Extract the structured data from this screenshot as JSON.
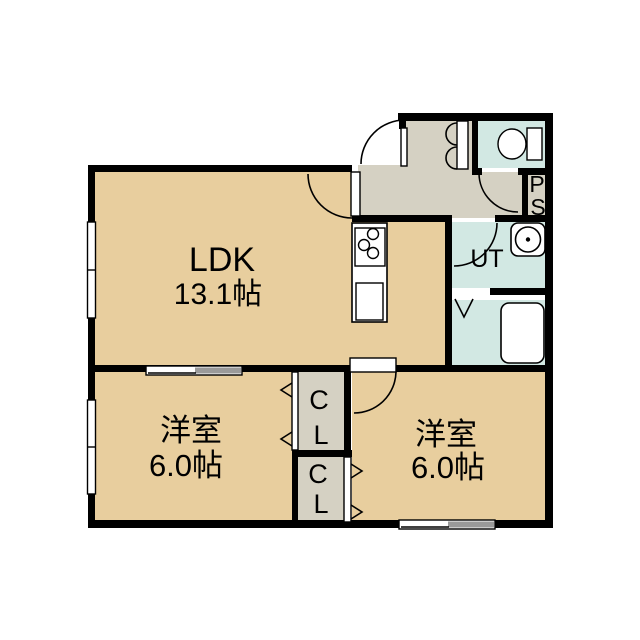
{
  "colors": {
    "room_tan": "#E8CE9E",
    "wet_cyan": "#D2E8E3",
    "hall_gray": "#D5D1C3",
    "panel_gray": "#9A9A9A",
    "wall_black": "#000000",
    "fixture_white": "#FFFFFF"
  },
  "rooms": {
    "ldk": {
      "name": "LDK",
      "size": "13.1帖"
    },
    "bedroom_left": {
      "name": "洋室",
      "size": "6.0帖"
    },
    "bedroom_right": {
      "name": "洋室",
      "size": "6.0帖"
    },
    "utility": {
      "label": "UT"
    },
    "pipe_shaft": {
      "letters": [
        "P",
        "S"
      ]
    },
    "closet_upper": {
      "letters": [
        "C",
        "L"
      ]
    },
    "closet_lower": {
      "letters": [
        "C",
        "L"
      ]
    }
  }
}
